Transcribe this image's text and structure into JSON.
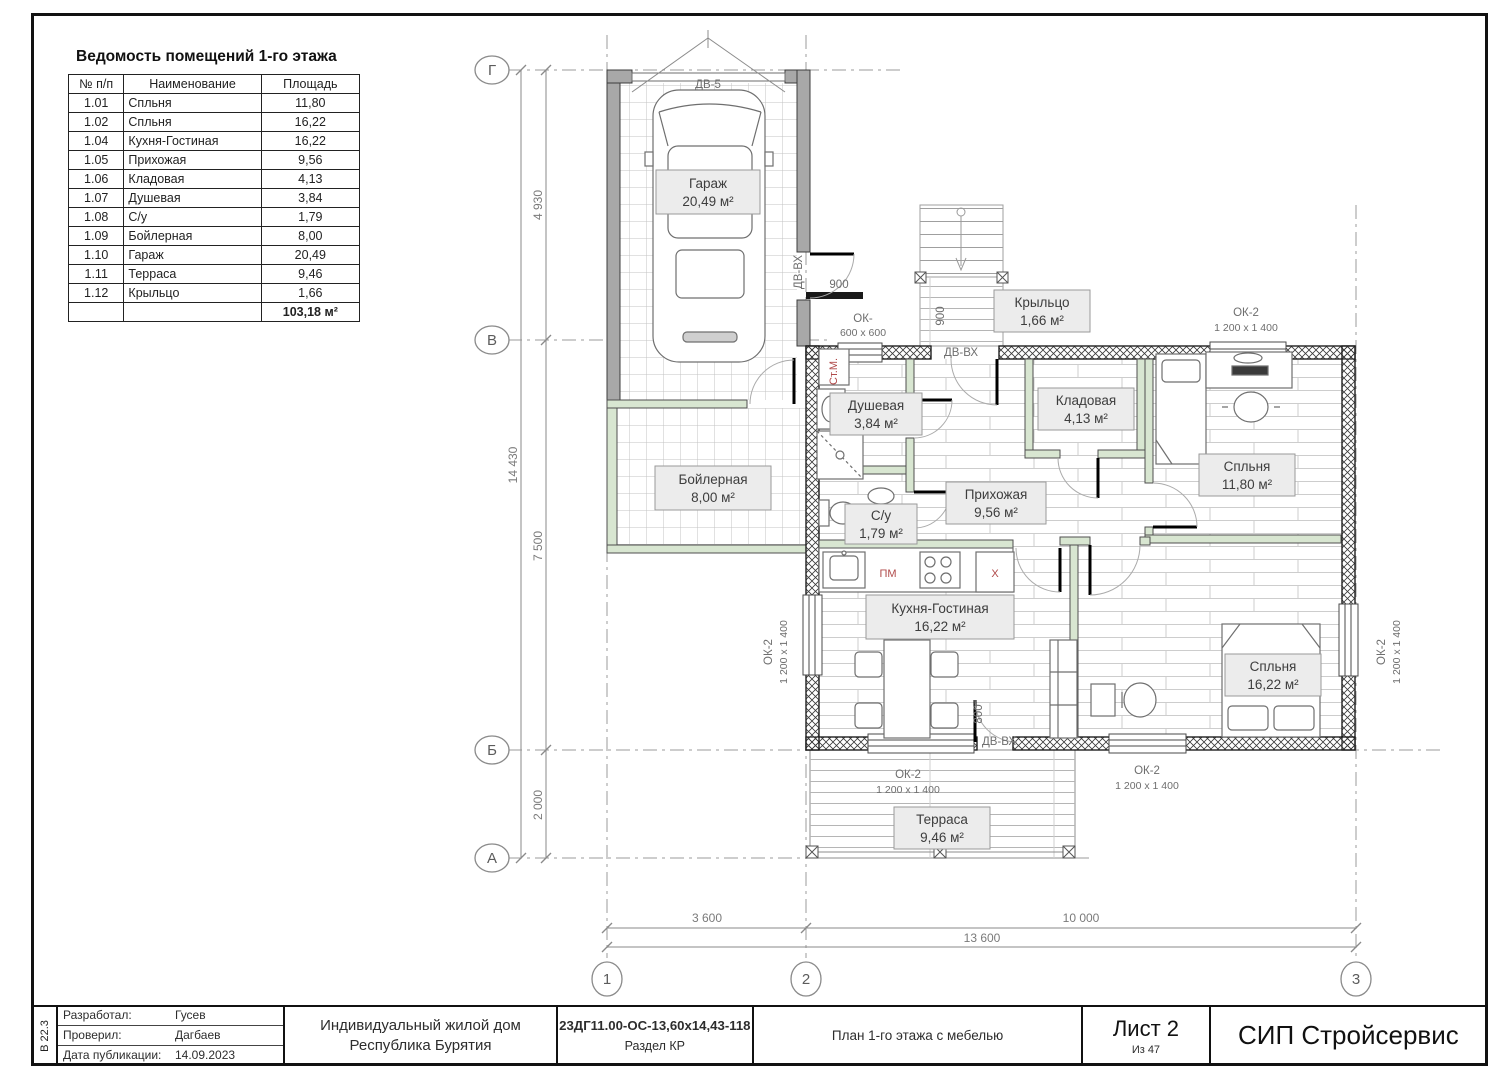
{
  "schedule": {
    "title": "Ведомость помещений 1-го этажа",
    "headers": [
      "№ п/п",
      "Наименование",
      "Площадь"
    ],
    "rows": [
      [
        "1.01",
        "Спльня",
        "11,80"
      ],
      [
        "1.02",
        "Спльня",
        "16,22"
      ],
      [
        "1.04",
        "Кухня-Гостиная",
        "16,22"
      ],
      [
        "1.05",
        "Прихожая",
        "9,56"
      ],
      [
        "1.06",
        "Кладовая",
        "4,13"
      ],
      [
        "1.07",
        "Душевая",
        "3,84"
      ],
      [
        "1.08",
        "С/у",
        "1,79"
      ],
      [
        "1.09",
        "Бойлерная",
        "8,00"
      ],
      [
        "1.10",
        "Гараж",
        "20,49"
      ],
      [
        "1.11",
        "Терраса",
        "9,46"
      ],
      [
        "1.12",
        "Крыльцо",
        "1,66"
      ]
    ],
    "total": "103,18 м²"
  },
  "plan": {
    "room_labels": [
      {
        "name": "Гараж",
        "area": "20,49 м²"
      },
      {
        "name": "Бойлерная",
        "area": "8,00 м²"
      },
      {
        "name": "Душевая",
        "area": "3,84 м²"
      },
      {
        "name": "С/у",
        "area": "1,79 м²"
      },
      {
        "name": "Прихожая",
        "area": "9,56 м²"
      },
      {
        "name": "Кладовая",
        "area": "4,13 м²"
      },
      {
        "name": "Спльня",
        "area": "11,80 м²"
      },
      {
        "name": "Кухня-Гостиная",
        "area": "16,22 м²"
      },
      {
        "name": "Спльня",
        "area": "16,22 м²"
      },
      {
        "name": "Терраса",
        "area": "9,46 м²"
      },
      {
        "name": "Крыльцо",
        "area": "1,66 м²"
      }
    ],
    "window_type2": "ОК-2",
    "window_type2_size": "1 200 x 1 400",
    "window_small": "ОК-",
    "window_small_size": "600 x 600",
    "door_entry": "ДВ-ВХ",
    "door_garage": "ДВ-5",
    "washer": "Ст.М.",
    "dishwasher": "ПМ",
    "fridge": "Х",
    "dim_900": "900",
    "dim_800": "800"
  },
  "axes": {
    "left": [
      "Г",
      "В",
      "Б",
      "А"
    ],
    "bottom": [
      "1",
      "2",
      "3"
    ]
  },
  "dimensions": {
    "left_segments": [
      "4 930",
      "7 500",
      "2 000"
    ],
    "left_total": "14 430",
    "bottom_segments": [
      "3 600",
      "10 000"
    ],
    "bottom_total": "13 600"
  },
  "title_block": {
    "stamp": "В 22.3",
    "developed_label": "Разработал:",
    "developed": "Гусев",
    "checked_label": "Проверил:",
    "checked": "Дагбаев",
    "date_label": "Дата публикации:",
    "date": "14.09.2023",
    "project_line1": "Индивидуальный жилой дом",
    "project_line2": "Республика Бурятия",
    "code": "23ДГ11.00-ОС-13,60х14,43-118",
    "section": "Раздел КР",
    "sheet_title": "План 1-го этажа с мебелью",
    "sheet_label": "Лист 2",
    "sheet_of": "Из 47",
    "company": "СИП Стройсервис"
  }
}
